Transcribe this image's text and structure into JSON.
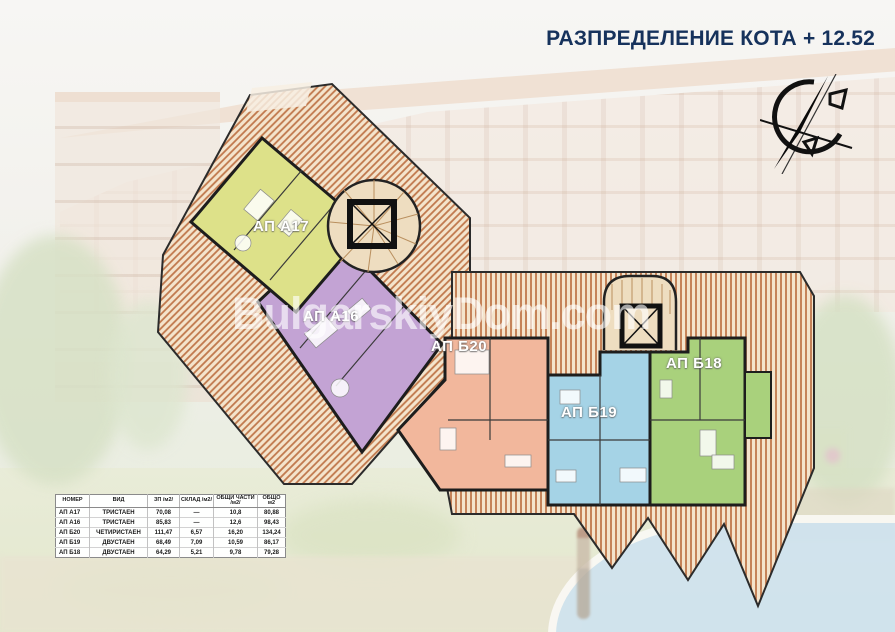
{
  "header": {
    "title": "РАЗПРЕДЕЛЕНИЕ КОТА + 12.52"
  },
  "watermark": "BulgarskiyDom.com",
  "compass": {
    "icon": "north-arrow"
  },
  "colors": {
    "title_text": "#16325c",
    "roof_bg": "#f4e4cc",
    "roof_stripe": "#c0784c",
    "stair_fill": "#eeddc0",
    "stair_step": "#b98f5e"
  },
  "plan": {
    "wall_color": "#1d1d1d",
    "apartments": [
      {
        "label": "АП А17",
        "color": "#dde189"
      },
      {
        "label": "АП А16",
        "color": "#c3a3d4"
      },
      {
        "label": "АП Б20",
        "color": "#f2b79c"
      },
      {
        "label": "АП Б19",
        "color": "#a5d3e6"
      },
      {
        "label": "АП Б18",
        "color": "#a9d17c"
      }
    ]
  },
  "table": {
    "headers": [
      "НОМЕР",
      "ВИД",
      "ЗП /м2/",
      "СКЛАД /м2/",
      "ОБЩИ ЧАСТИ /м2/",
      "ОБЩО м2"
    ],
    "rows": [
      [
        "АП А17",
        "ТРИСТАЕН",
        "70,08",
        "—",
        "10,8",
        "80,88"
      ],
      [
        "АП А16",
        "ТРИСТАЕН",
        "85,83",
        "—",
        "12,6",
        "98,43"
      ],
      [
        "АП Б20",
        "ЧЕТИРИСТАЕН",
        "111,47",
        "6,57",
        "16,20",
        "134,24"
      ],
      [
        "АП Б19",
        "ДВУСТАЕН",
        "68,49",
        "7,09",
        "10,59",
        "86,17"
      ],
      [
        "АП Б18",
        "ДВУСТАЕН",
        "64,29",
        "5,21",
        "9,78",
        "79,28"
      ]
    ]
  }
}
